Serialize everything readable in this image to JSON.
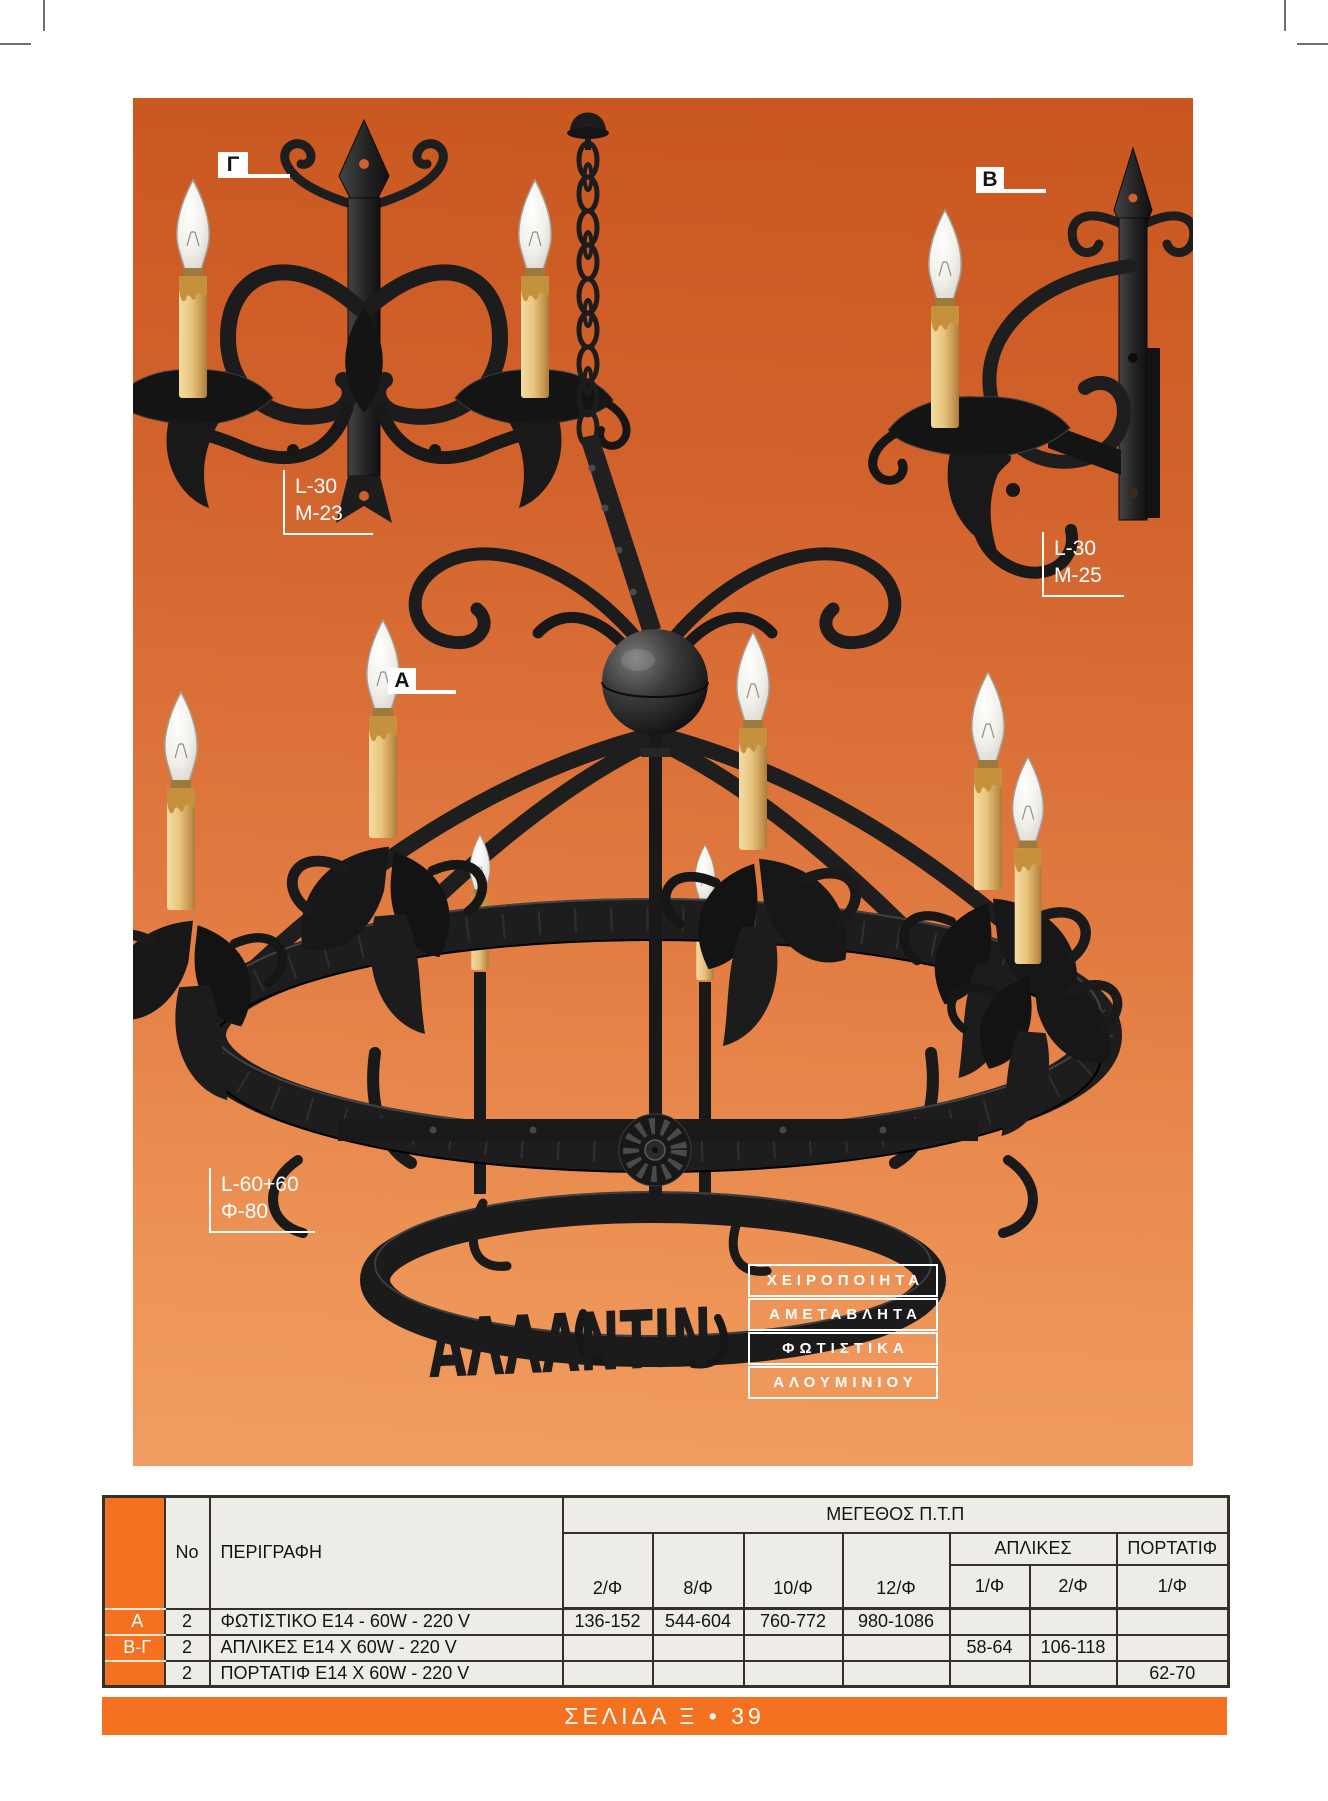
{
  "brand": {
    "script": "ΑΛΛΑΝΤΙΝ",
    "tagline": [
      "ΧΕΙΡΟΠΟΙΗΤΑ",
      "ΑΜΕΤΑΒΛΗΤΑ",
      "ΦΩΤΙΣΤΙΚΑ",
      "ΑΛΟΥΜΙΝΙΟΥ"
    ]
  },
  "markers": {
    "gamma": {
      "label": "Γ"
    },
    "beta": {
      "label": "B"
    },
    "alpha": {
      "label": "A"
    }
  },
  "codes": {
    "left": {
      "line1": "L-30",
      "line2": "M-23"
    },
    "right": {
      "line1": "L-30",
      "line2": "M-25"
    },
    "chandelier": {
      "line1": "L-60+60",
      "line2": "Φ-80"
    }
  },
  "table": {
    "group_header": "ΜΕΓΕΘΟΣ Π.Τ.Π",
    "col_no": "No",
    "col_desc": "ΠΕΡΙΓΡΑΦΗ",
    "size_cols": [
      "2/Φ",
      "8/Φ",
      "10/Φ",
      "12/Φ"
    ],
    "group_apl": "ΑΠΛΙΚΕΣ",
    "apl_cols": [
      "1/Φ",
      "2/Φ"
    ],
    "group_port": "ΠΟΡΤΑΤΙΦ",
    "port_col": "1/Φ",
    "rows": [
      {
        "key": "A",
        "no": "2",
        "desc": "ΦΩΤΙΣΤΙΚΟ Ε14 - 60W - 220 V",
        "vals": [
          "136-152",
          "544-604",
          "760-772",
          "980-1086",
          "",
          "",
          ""
        ]
      },
      {
        "key": "Β-Γ",
        "no": "2",
        "desc": "ΑΠΛΙΚΕΣ Ε14 Χ 60W - 220 V",
        "vals": [
          "",
          "",
          "",
          "",
          "58-64",
          "106-118",
          ""
        ]
      },
      {
        "key": "",
        "no": "2",
        "desc": "ΠΟΡΤΑΤΙΦ Ε14 Χ 60W - 220 V",
        "vals": [
          "",
          "",
          "",
          "",
          "",
          "",
          "62-70"
        ]
      }
    ]
  },
  "footer": {
    "text": "ΣΕΛΙΔΑ Ξ • 39"
  },
  "colors": {
    "panel_top": "#c9561f",
    "panel_bottom": "#f19d62",
    "accent_orange": "#f3711f",
    "table_bg": "#edece7"
  }
}
